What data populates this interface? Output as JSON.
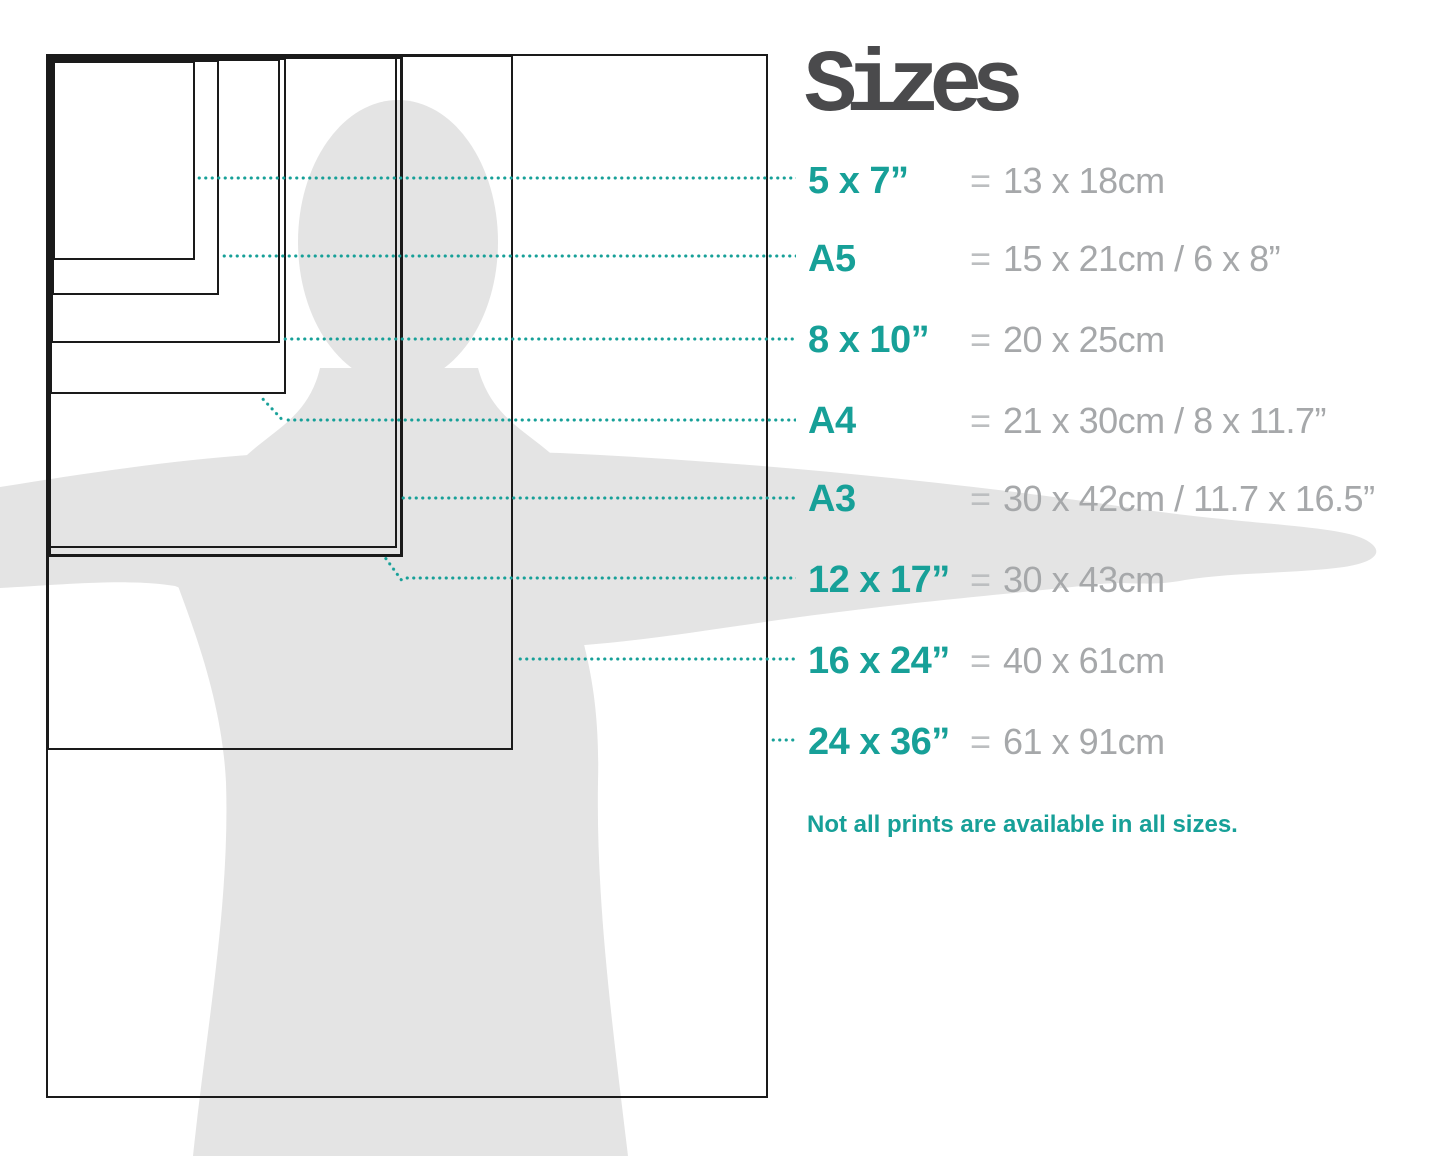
{
  "title": "Sizes",
  "equals": "=",
  "note": "Not all prints are available in all sizes.",
  "colors": {
    "accent": "#17a098",
    "value-gray": "#a6a8aa",
    "equals-gray": "#bcbec0",
    "title-gray": "#4a4a4c",
    "silhouette": "#e4e4e4",
    "line-black": "#1a1a1a"
  },
  "rows": [
    {
      "id": "5x7",
      "label": "5 x 7”",
      "value": "13 x 18cm"
    },
    {
      "id": "a5",
      "label": "A5",
      "value": "15 x 21cm / 6 x 8”"
    },
    {
      "id": "8x10",
      "label": "8 x 10”",
      "value": "20 x 25cm"
    },
    {
      "id": "a4",
      "label": "A4",
      "value": "21 x 30cm / 8 x 11.7”"
    },
    {
      "id": "a3",
      "label": "A3",
      "value": "30 x 42cm / 11.7 x 16.5”"
    },
    {
      "id": "12x17",
      "label": "12 x 17”",
      "value": "30 x 43cm"
    },
    {
      "id": "16x24",
      "label": "16 x 24”",
      "value": "40 x 61cm"
    },
    {
      "id": "24x36",
      "label": "24 x 36”",
      "value": "61 x 91cm"
    }
  ]
}
